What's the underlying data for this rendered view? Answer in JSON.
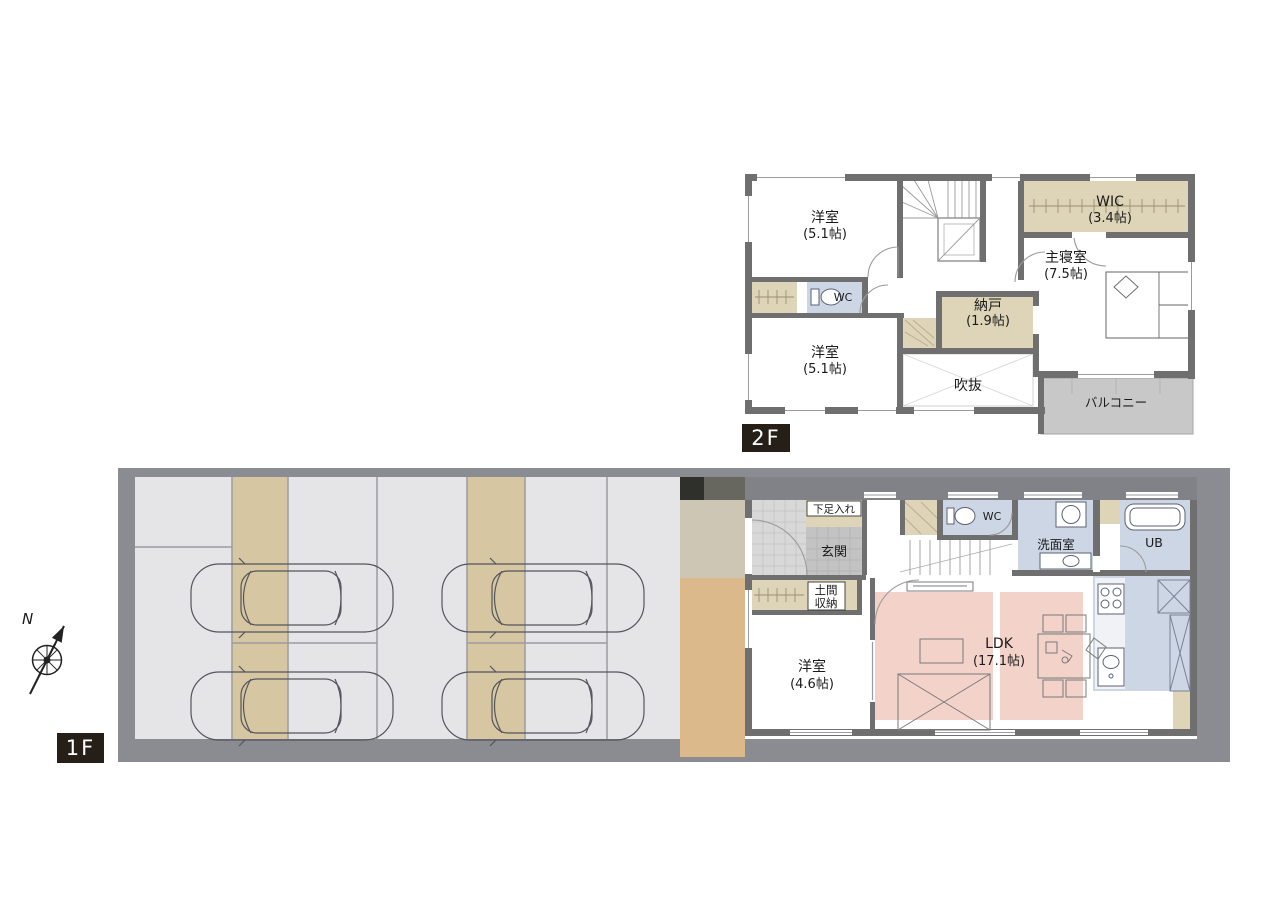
{
  "floor2": {
    "label": "2F",
    "rooms": {
      "yoshitsu_top": {
        "name": "洋室",
        "size": "(5.1帖)"
      },
      "wic": {
        "name": "WIC",
        "size": "(3.4帖)"
      },
      "master_bedroom": {
        "name": "主寝室",
        "size": "(7.5帖)"
      },
      "wc": {
        "name": "WC"
      },
      "nando": {
        "name": "納戸",
        "size": "(1.9帖)"
      },
      "yoshitsu_bottom": {
        "name": "洋室",
        "size": "(5.1帖)"
      },
      "fukinuke": {
        "name": "吹抜"
      },
      "balcony": {
        "name": "バルコニー"
      }
    }
  },
  "floor1": {
    "label": "1F",
    "rooms": {
      "shoe_cabinet": {
        "name": "下足入れ"
      },
      "genkan": {
        "name": "玄関"
      },
      "wc": {
        "name": "WC"
      },
      "senmenshitsu": {
        "name": "洗面室"
      },
      "unit_bath": {
        "name": "UB"
      },
      "doma_shuno": {
        "line1": "土間",
        "line2": "収納"
      },
      "yoshitsu": {
        "name": "洋室",
        "size": "(4.6帖)"
      },
      "ldk": {
        "name": "LDK",
        "size": "(17.1帖)"
      }
    },
    "parking": {
      "car_count": 4
    }
  },
  "compass": {
    "north": "N"
  },
  "colors": {
    "wall": "#6f6f6f",
    "site_border": "#8a8c91",
    "house_band": "#808287",
    "parking_concrete": "#e5e5e8",
    "gravel_strip": "#d6c7a2",
    "closet_tan": "#ded4b7",
    "wet_blue": "#cdd6e5",
    "ldk_pink": "#f3d2ca",
    "balcony_gray": "#c8c8c8",
    "entry_gray": "#c3c3c3",
    "deck_tan": "#dcb98b",
    "floor_label_bg": "#261f17"
  }
}
